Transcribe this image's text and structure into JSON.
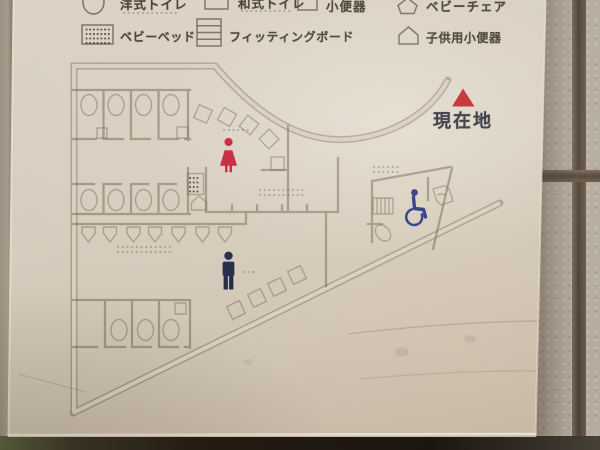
{
  "legend": {
    "row1": [
      {
        "icon": "western-toilet-icon",
        "label": "洋式トイレ"
      },
      {
        "icon": "squat-toilet-icon",
        "label": "和式トイレ"
      },
      {
        "icon": "urinal-icon",
        "label": "小便器"
      },
      {
        "icon": "baby-chair-icon",
        "label": "ベビーチェア"
      }
    ],
    "row2": [
      {
        "icon": "baby-bed-icon",
        "label": "ベビーベッド"
      },
      {
        "icon": "fitting-board-icon",
        "label": "フィッティングボード"
      },
      {
        "icon": "child-urinal-icon",
        "label": "子供用小便器"
      }
    ]
  },
  "marker": {
    "symbol": "red-triangle-icon",
    "label": "現在地"
  },
  "map_icons": {
    "female": "woman-pictogram-icon",
    "male": "man-pictogram-icon",
    "accessible": "wheelchair-pictogram-icon"
  },
  "colors": {
    "female": "#c5243a",
    "male": "#202744",
    "accessible": "#2a3a86",
    "marker": "#bf2d33",
    "legend_text": "#474035",
    "marker_text": "#35353f",
    "wall": "#75634e",
    "plate": "#d7cdbf"
  }
}
